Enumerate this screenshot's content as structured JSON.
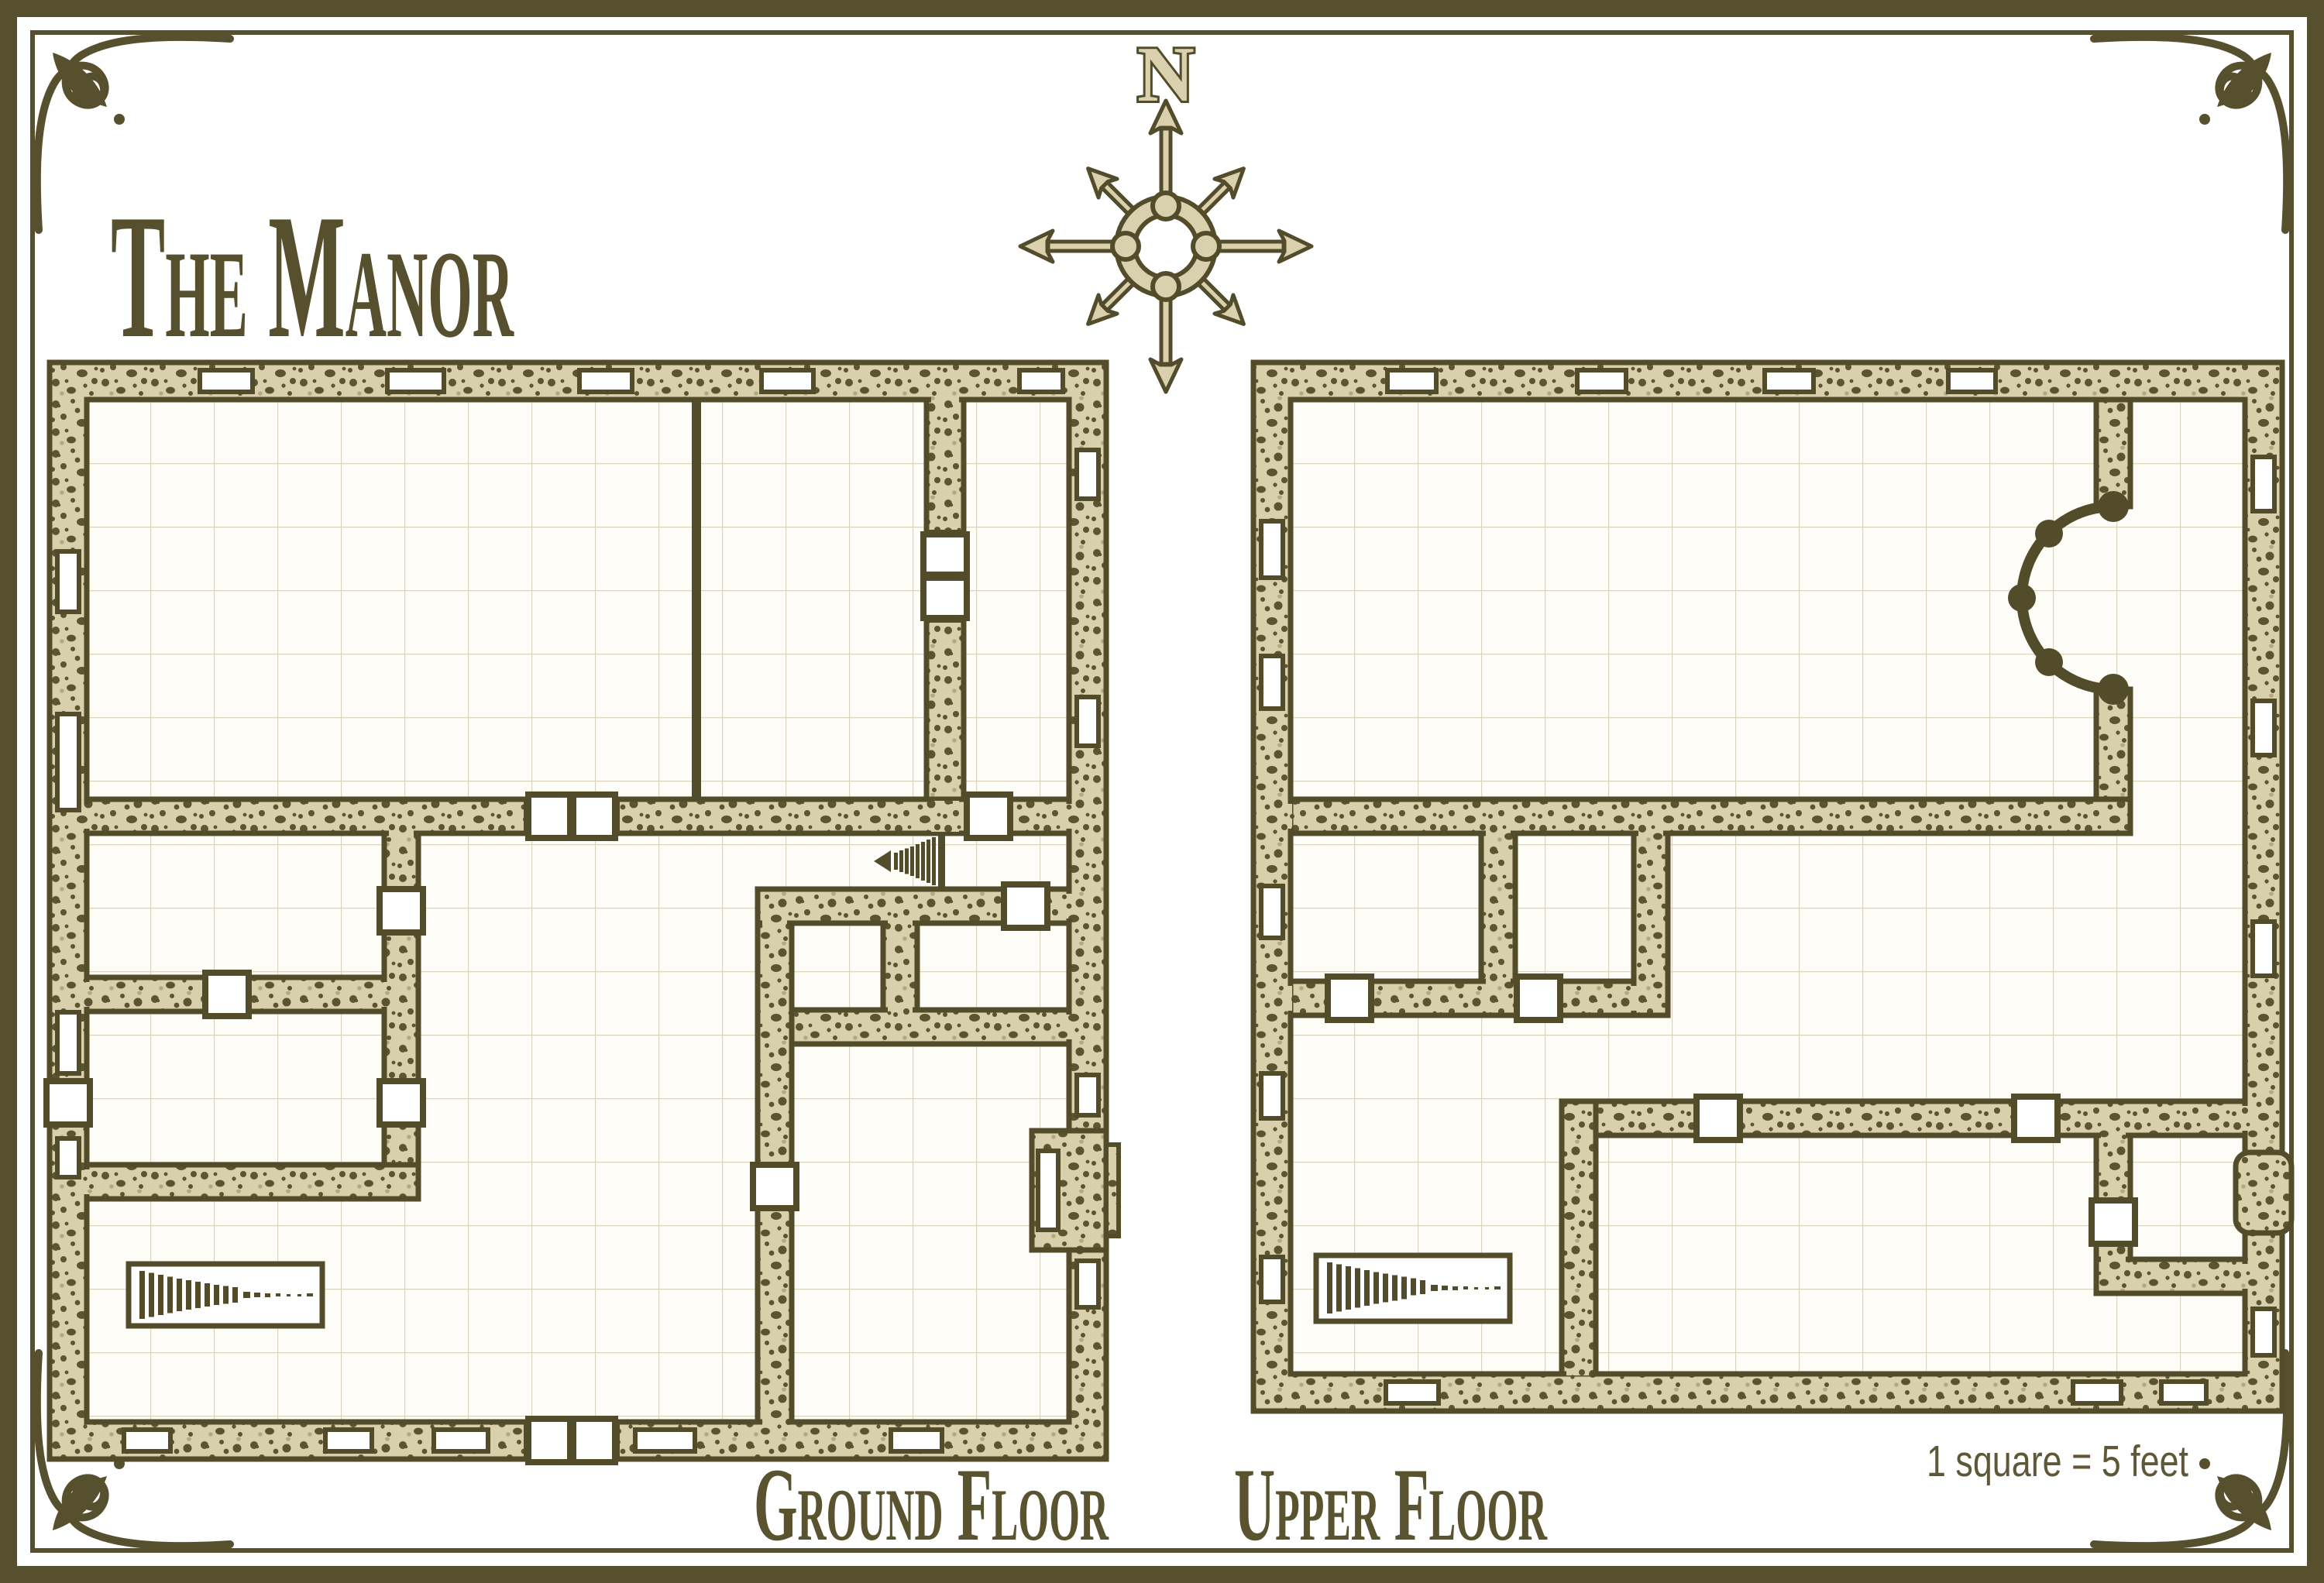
{
  "title": "The Manor",
  "compass": {
    "icon": "compass-rose-icon",
    "north_label": "N"
  },
  "floors": [
    {
      "label": "Ground Floor"
    },
    {
      "label": "Upper Floor"
    }
  ],
  "scale_note": "1 square = 5 feet",
  "colors": {
    "ink_olive": "#57502e",
    "wall_outline": "#534c2b",
    "wall_fill": "#d8cfab",
    "wall_speckle": "#5b5430",
    "floor": "#fffdf7",
    "grid_line": "#dad4c0",
    "paper": "#ffffff"
  },
  "symbols": {
    "door": "white square across wall",
    "double_door": "two white squares across wall",
    "window": "white slit in wall",
    "stairs": "tapering bar treads",
    "gallery_arc": "columned semicircular opening",
    "entrance_porch": "projecting porch with door"
  }
}
